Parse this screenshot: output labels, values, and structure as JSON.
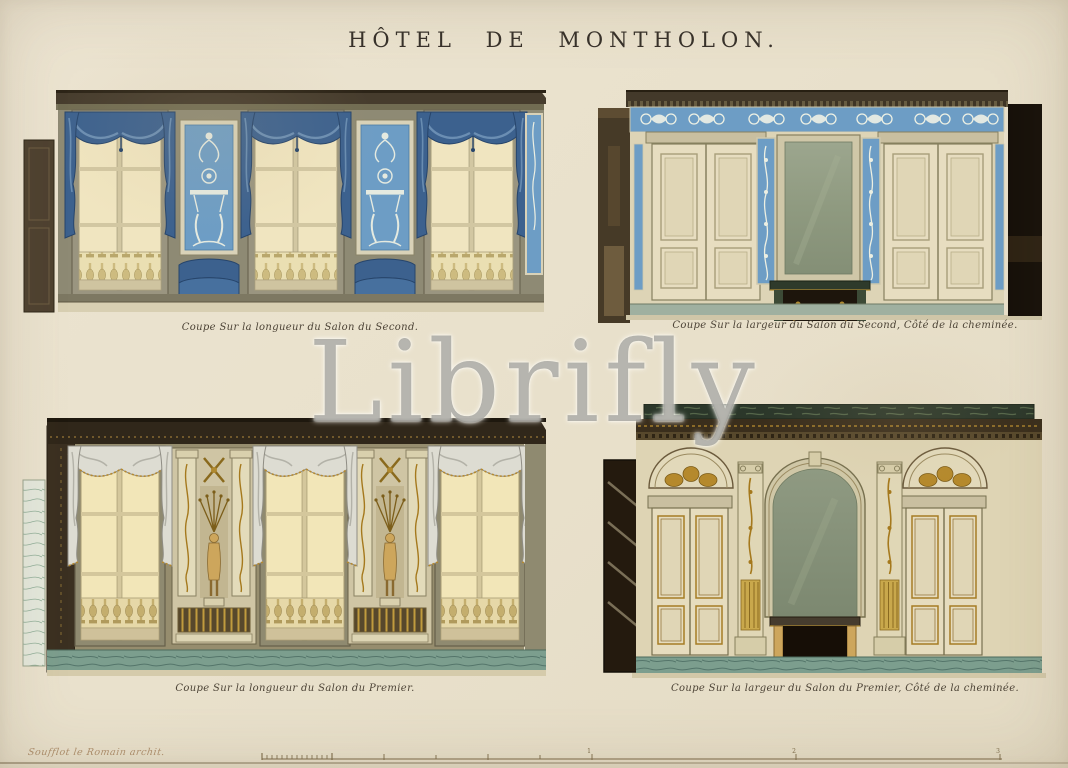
{
  "title": "HÔTEL  DE  MONTHOLON.",
  "watermark": "Librifly",
  "plate": {
    "panels": [
      {
        "id": "top-left",
        "caption": "Coupe Sur la longueur du Salon du Second."
      },
      {
        "id": "top-right",
        "caption": "Coupe Sur la largeur du Salon du Second, Côté de la cheminée."
      },
      {
        "id": "bottom-left",
        "caption": "Coupe Sur la longueur du Salon du Premier."
      },
      {
        "id": "bottom-right",
        "caption": "Coupe Sur la largeur du Salon du Premier, Côté de la cheminée."
      }
    ],
    "signature": "Soufflot le Romain archit.",
    "scale_labels": [
      "1",
      "2",
      "3"
    ]
  },
  "colors": {
    "paper": "#e9e1cc",
    "ink": "#37312a",
    "caption_ink": "#4c4336",
    "salon_second_blue": "#6d9dc5",
    "drape_blue": "#3c618e",
    "window_cream": "#f0e5c0",
    "wood_dark": "#463c2d",
    "gold": "#b08a30",
    "mirror_green": "#8f9a82",
    "marble_green": "#7c9e8e",
    "watermark_gray": "#7c7b77"
  }
}
